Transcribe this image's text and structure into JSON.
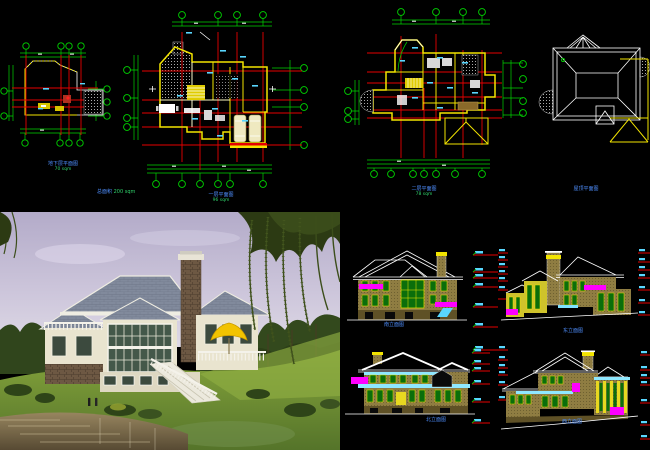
{
  "sheet": {
    "background": "#000000",
    "type": "villa construction drawing set with photo rendering"
  },
  "colors": {
    "cad_green": "#00d400",
    "cad_red": "#e60000",
    "cad_yellow": "#f2e400",
    "cad_cyan": "#59d7ff",
    "cad_magenta": "#ff00ff",
    "caption_blue": "#4f8fff",
    "area_green": "#2fd06a",
    "elevation_wall_tan": "#8f7d42",
    "window_green": "#0b6e0b",
    "photo_sky": "#c3bcd6",
    "photo_lawn": "#70902f",
    "photo_roof_gray": "#818a9c"
  },
  "plans": [
    {
      "id": "basement",
      "title": "地下层平面图",
      "area": "70 sqm"
    },
    {
      "id": "first-floor",
      "title": "一层平面图",
      "area": "96 sqm"
    },
    {
      "id": "second-floor",
      "title": "二层平面图",
      "area": "78 sqm"
    },
    {
      "id": "roof",
      "title": "屋顶平面图",
      "area": ""
    }
  ],
  "notes": {
    "total_area_label": "总面积",
    "total_area_value": "200 sqm"
  },
  "elevations": [
    {
      "id": "south",
      "title": "南立面图"
    },
    {
      "id": "east",
      "title": "东立面图"
    },
    {
      "id": "north",
      "title": "北立面图"
    },
    {
      "id": "west",
      "title": "西立面图"
    }
  ]
}
